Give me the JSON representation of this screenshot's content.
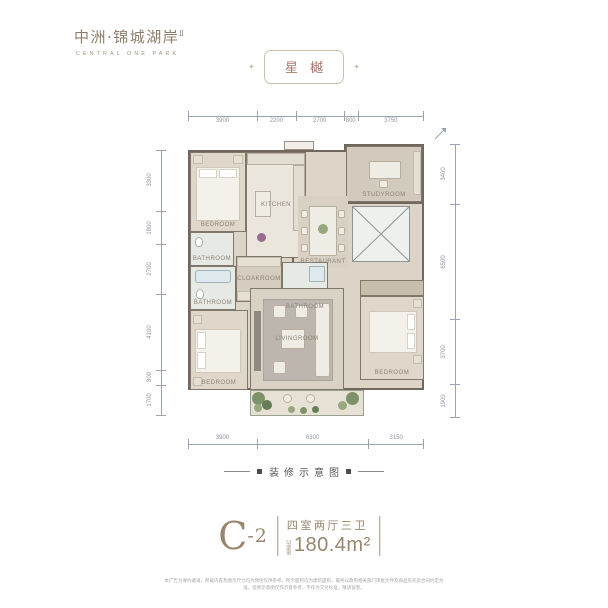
{
  "brand": {
    "name_cn": "中洲·锦城湖岸",
    "name_sup": "Ⅱ",
    "name_en": "CENTRAL ONE PARK"
  },
  "badge": {
    "label": "星樾",
    "ornament": "✦"
  },
  "plan": {
    "rooms": [
      {
        "label": "BEDROOM"
      },
      {
        "label": "KITCHEN"
      },
      {
        "label": "STUDYROOM"
      },
      {
        "label": "RESTAURANT"
      },
      {
        "label": "BATHROOM"
      },
      {
        "label": "BATHROOM"
      },
      {
        "label": "CLOAKROOM"
      },
      {
        "label": "BATHROOM"
      },
      {
        "label": "BEDROOM"
      },
      {
        "label": "LIVINGROOM"
      },
      {
        "label": "BEDROOM"
      }
    ],
    "dims": {
      "top": [
        "3900",
        "2200",
        "2700",
        "800",
        "3750"
      ],
      "left": [
        "3300",
        "1800",
        "2700",
        "4100",
        "800",
        "1700"
      ],
      "right": [
        "3400",
        "6500",
        "3700",
        "1900"
      ],
      "bottom": [
        "3900",
        "6300",
        "3150"
      ]
    }
  },
  "caption": {
    "label": "装修示意图"
  },
  "unit": {
    "code": "C",
    "suffix": "-2",
    "layout": "四室两厅三卫",
    "area_prefix": "建面约",
    "area_value": "180.4m²"
  },
  "disclaimer": "本广告为要约邀请，所载内容及图示尺寸均为预估仅供参考，所示面积均为建筑面积，最终以政府相关部门审批文件及商品房买卖合同约定为准，装修示意图仅作示意参考，不作为交付标准，敬请留意。"
}
